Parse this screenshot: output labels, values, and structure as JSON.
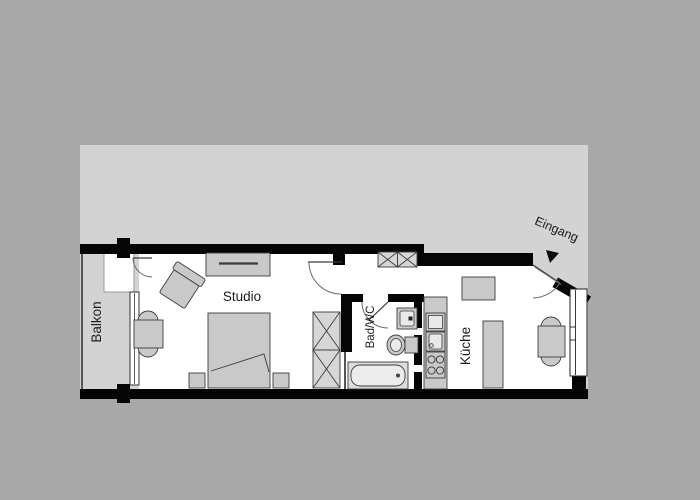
{
  "floorplan": {
    "type": "apartment-floor-plan",
    "rooms": {
      "balcony": {
        "label": "Balkon"
      },
      "studio": {
        "label": "Studio"
      },
      "bathroom": {
        "label": "Bad/WC"
      },
      "kitchen": {
        "label": "Küche"
      },
      "entrance": {
        "label": "Eingang"
      }
    },
    "colors": {
      "page_background": "#a8a8a8",
      "plot_backdrop": "#d3d3d3",
      "wall": "#050505",
      "interior": "#ffffff",
      "furniture_fill": "#c9c9c9",
      "hatch_fill": "#d6d6d6",
      "label_text": "#1c1c1c"
    },
    "furniture": {
      "studio": [
        "sideboard",
        "armchair",
        "dining-table",
        "two-chairs",
        "double-bed",
        "nightstand-left",
        "nightstand-right",
        "wardrobe-x2"
      ],
      "hallway": [
        "closet-x2"
      ],
      "bathroom": [
        "washbasin",
        "toilet",
        "bathtub"
      ],
      "kitchen": [
        "kitchen-counter",
        "cabinet",
        "sink",
        "stove-4-burners",
        "wall-cabinet",
        "tall-counter",
        "dining-table",
        "two-chairs"
      ],
      "openings": [
        "balcony-door",
        "studio-door",
        "bathroom-door",
        "entrance-door",
        "balcony-window",
        "kitchen-window"
      ]
    }
  }
}
